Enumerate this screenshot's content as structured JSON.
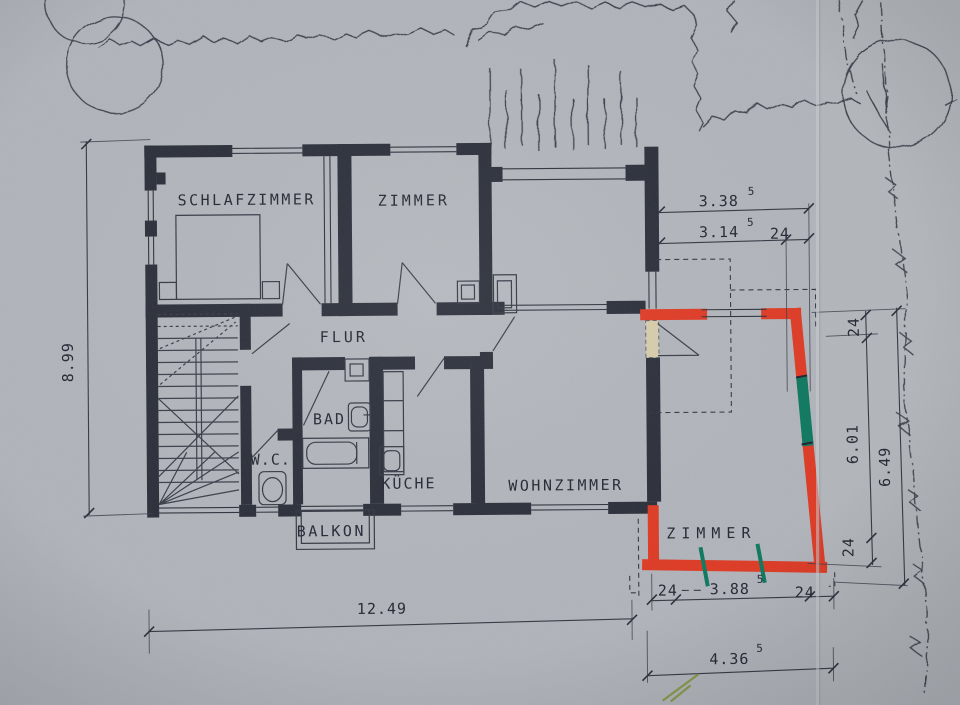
{
  "drawing_type": "floor-plan-scan",
  "rooms": {
    "schlafzimmer": "SCHLAFZIMMER",
    "zimmer_top": "ZIMMER",
    "flur": "FLUR",
    "bad": "BAD",
    "wc": "W.C.",
    "kueche": "KÜCHE",
    "wohnzimmer": "WOHNZIMMER",
    "balkon": "BALKON",
    "zimmer_extension": "ZIMMER"
  },
  "dims": {
    "height_left": "8.99",
    "width_bottom": "12.49",
    "top_total": "3.38",
    "top_total_sup": "5",
    "top_clear": "3.14",
    "top_clear_sup": "5",
    "top_wall": "24",
    "right_wall_top": "24",
    "right_clear": "6.01",
    "right_total": "6.49",
    "right_wall_bottom": "24",
    "ext_wall_left": "24",
    "ext_clear": "3.88",
    "ext_clear_sup": "5",
    "ext_wall_right": "24",
    "ext_total": "4.36",
    "ext_total_sup": "5"
  },
  "colors": {
    "paper": "#b4b8be",
    "ink": "#2b2f3a",
    "extension_red": "#e23b25",
    "window_green": "#0e7a60",
    "removed_beige": "#d9cfae",
    "scribble_green": "#8a9a4a"
  }
}
